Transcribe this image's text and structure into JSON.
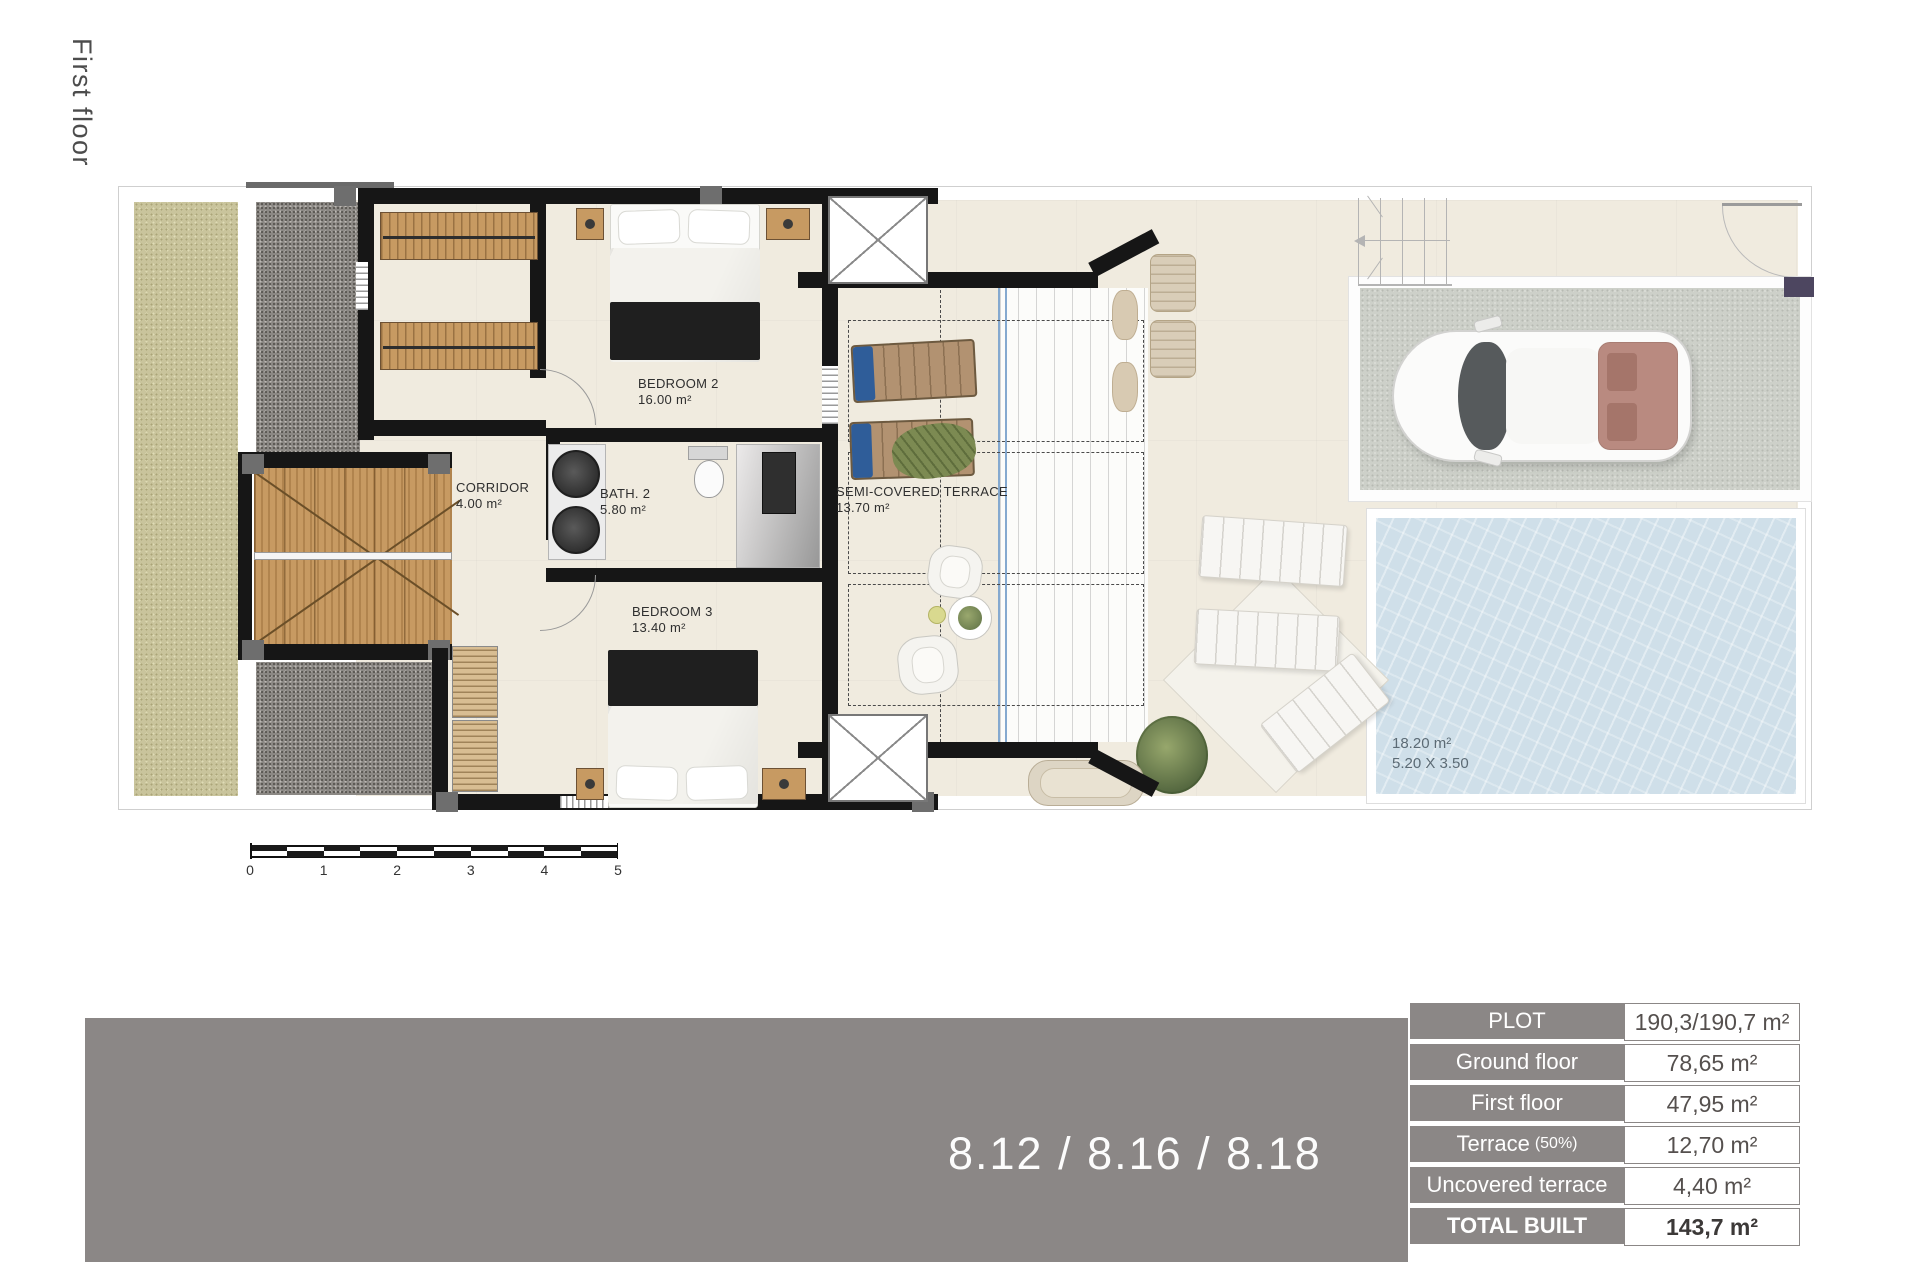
{
  "page": {
    "floor_title": "First floor"
  },
  "plan": {
    "rooms": [
      {
        "name": "BEDROOM 2",
        "area": "16.00 m²"
      },
      {
        "name": "CORRIDOR",
        "area": "4.00 m²"
      },
      {
        "name": "BATH. 2",
        "area": "5.80 m²"
      },
      {
        "name": "BEDROOM 3",
        "area": "13.40 m²"
      },
      {
        "name": "SEMI-COVERED TERRACE",
        "area": "13.70 m²"
      }
    ],
    "pool": {
      "area": "18.20 m²",
      "dimensions": "5.20 X 3.50"
    },
    "scale_ticks": [
      "0",
      "1",
      "2",
      "3",
      "4",
      "5"
    ]
  },
  "banner": {
    "units": "8.12 / 8.16 / 8.18"
  },
  "summary_table": {
    "rows": [
      {
        "label": "PLOT",
        "value": "190,3/190,7 m²"
      },
      {
        "label": "Ground floor",
        "value": "78,65 m²"
      },
      {
        "label": "First floor",
        "value": "47,95 m²"
      },
      {
        "label": "Terrace",
        "label_suffix": "(50%)",
        "value": "12,70 m²"
      },
      {
        "label": "Uncovered terrace",
        "value": "4,40 m²"
      },
      {
        "label": "TOTAL BUILT",
        "value": "143,7 m²"
      }
    ]
  },
  "colors": {
    "banner_gray": "#8b8786",
    "wall_black": "#161616",
    "pool_water": "#cfdfe9",
    "grass_olive": "#c9c49c",
    "gravel_gray": "#8b8884",
    "wood": "#c79a62",
    "floor_beige": "#f0ebdf"
  }
}
